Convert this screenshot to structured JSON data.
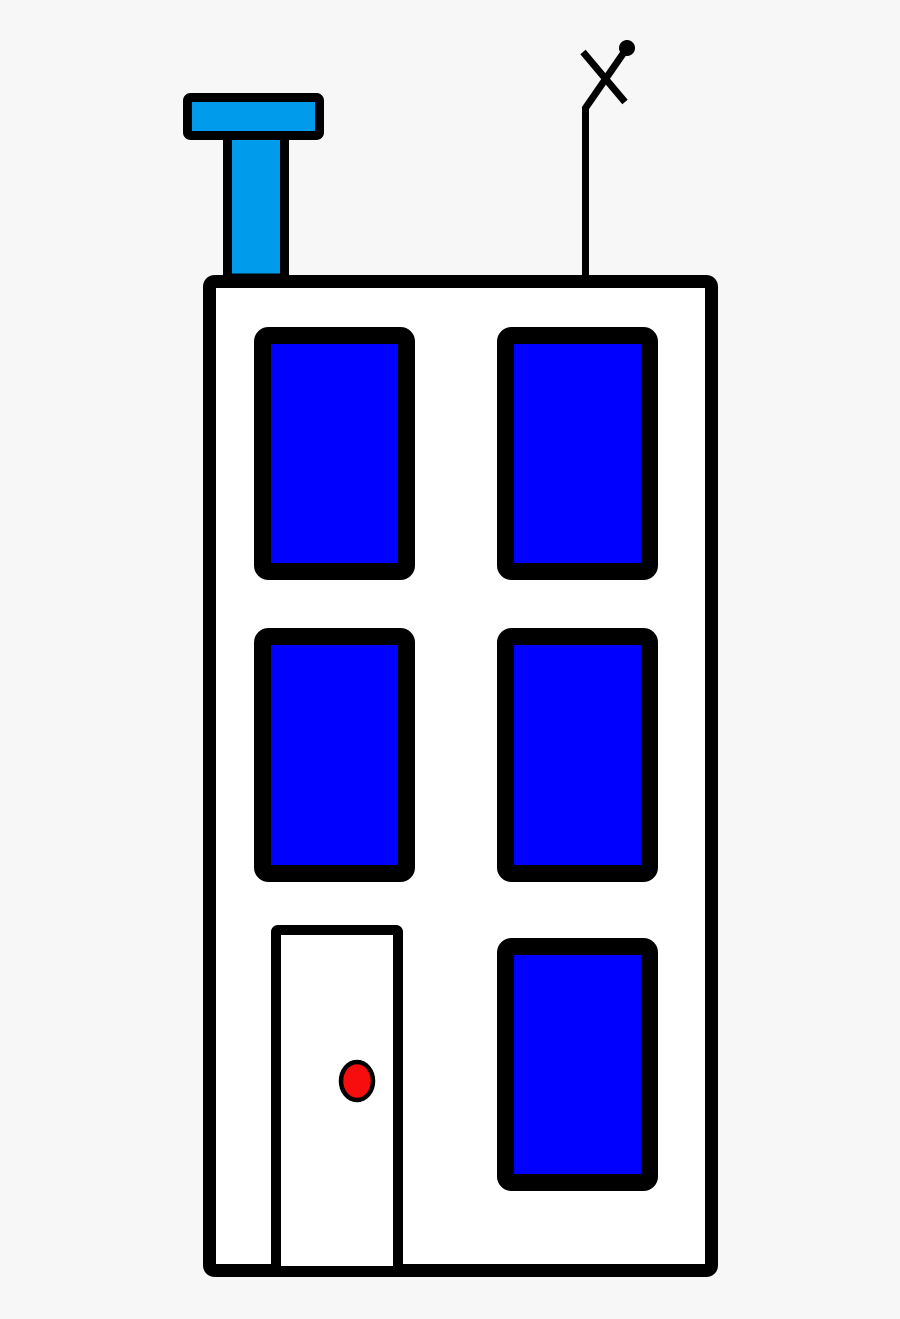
{
  "scene": {
    "subject": "apartment-building-clipart",
    "floors": 3,
    "window_count": 5,
    "window_columns": 2,
    "elements": [
      "chimney",
      "antenna",
      "building-facade",
      "window-grid",
      "door",
      "doorknob"
    ]
  },
  "colors": {
    "background": "#f7f7f7",
    "outline": "#000000",
    "wall": "#ffffff",
    "window": "#0000ff",
    "chimney": "#009ceb",
    "door": "#ffffff",
    "doorknob": "#f70d0d"
  }
}
